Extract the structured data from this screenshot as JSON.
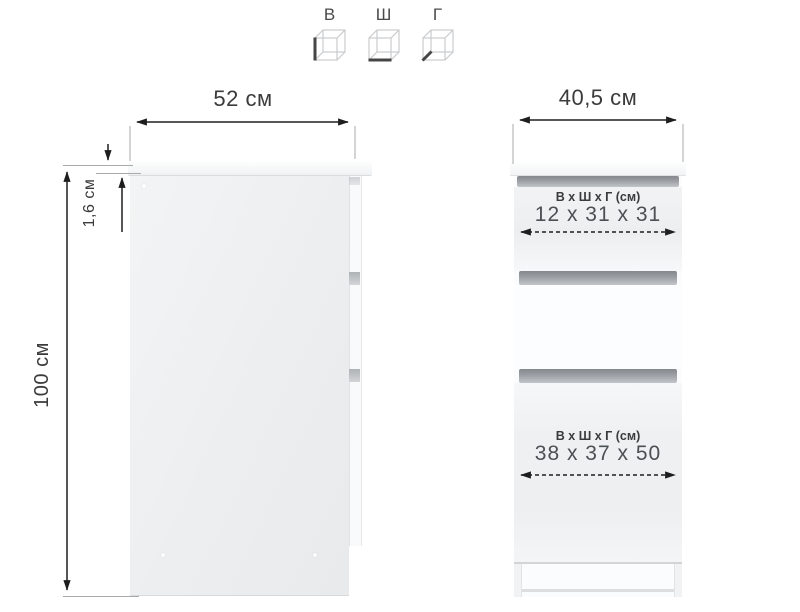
{
  "legend": {
    "items": [
      {
        "label": "В",
        "icon": "cube-height-icon"
      },
      {
        "label": "Ш",
        "icon": "cube-width-icon"
      },
      {
        "label": "Г",
        "icon": "cube-depth-icon"
      }
    ]
  },
  "side_view": {
    "width_label": "52 см",
    "height_label": "100 см",
    "top_thickness_label": "1,6 см"
  },
  "front_view": {
    "width_label": "40,5 см",
    "top_drawer": {
      "header": "В х Ш х Г (см)",
      "value": "12 х 31 х 31"
    },
    "bottom_drawer": {
      "header": "В х Ш х Г (см)",
      "value": "38 х 37 х 50"
    }
  },
  "colors": {
    "dimension_line": "#1e1e1e",
    "guide_line": "#a8abad",
    "label_text": "#3b3b3b",
    "value_text": "#4d5052",
    "drawer_gap": "#84888d"
  }
}
